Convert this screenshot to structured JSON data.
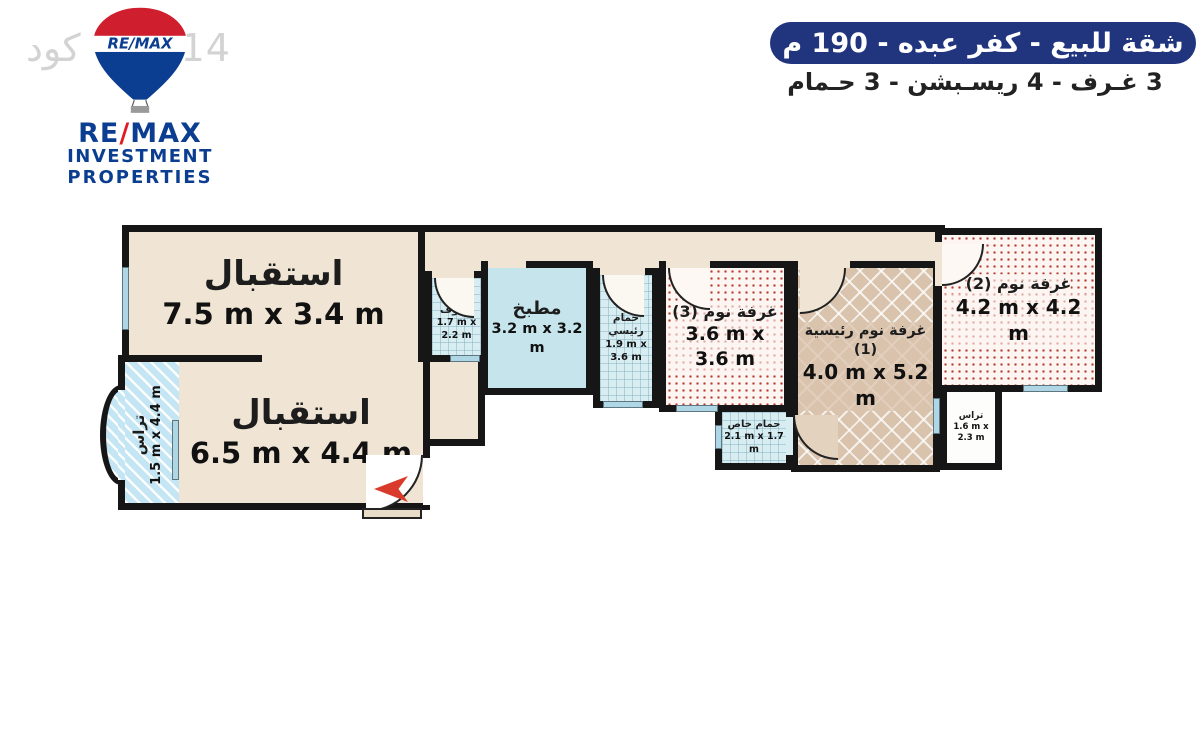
{
  "watermark": {
    "code_label": "كود",
    "code_number": "1014"
  },
  "logo": {
    "balloon_text": "RE/MAX",
    "name_re": "RE",
    "name_slash": "/",
    "name_max": "MAX",
    "line2": "INVESTMENT",
    "line3": "PROPERTIES"
  },
  "header": {
    "title": "شقة للبيع - كفر عبده - 190 م",
    "subtitle": "3 غـرف - 4 ريسـبشن - 3 حـمام"
  },
  "colors": {
    "banner": "#21357f",
    "remax_blue": "#0b3d91",
    "remax_red": "#e11b22",
    "wall": "#161616",
    "floor_beige": "#f0e5d4",
    "kitchen_blue": "#c6e4ec",
    "tile_blue": "#d8edf2",
    "dot_red": "#b7382f",
    "parquet_brown": "#d9c3ac",
    "terrace_blue": "#c4e6f4",
    "glass_blue": "#aed6e4",
    "arrow_red": "#d93a2b"
  },
  "floorplan": {
    "rooms": [
      {
        "id": "reception-1",
        "name": "استقبال",
        "dims": "7.5 m x 3.4 m"
      },
      {
        "id": "reception-2",
        "name": "استقبال",
        "dims": "6.5 m x 4.4 m"
      },
      {
        "id": "terrace-left",
        "name": "تراس",
        "dims": "1.5 m x 4.4 m"
      },
      {
        "id": "guest-bathroom",
        "name": "حمام ضيوف",
        "dims": "1.7 m x 2.2 m"
      },
      {
        "id": "kitchen",
        "name": "مطبخ",
        "dims": "3.2 m x 3.2 m"
      },
      {
        "id": "master-bathroom",
        "name": "حمام رئيسي",
        "dims": "1.9 m x 3.6 m"
      },
      {
        "id": "bedroom-3",
        "name": "غرفة نوم (3)",
        "dims": "3.6 m x 3.6 m"
      },
      {
        "id": "private-bathroom",
        "name": "حمام خاص",
        "dims": "2.1 m x 1.7 m"
      },
      {
        "id": "master-bedroom",
        "name": "غرفة نوم رئيسية (1)",
        "dims": "4.0 m x 5.2 m"
      },
      {
        "id": "bedroom-2",
        "name": "غرفة نوم (2)",
        "dims": "4.2 m x 4.2 m"
      },
      {
        "id": "terrace-right",
        "name": "تراس",
        "dims": "1.6 m x 2.3 m"
      }
    ]
  }
}
